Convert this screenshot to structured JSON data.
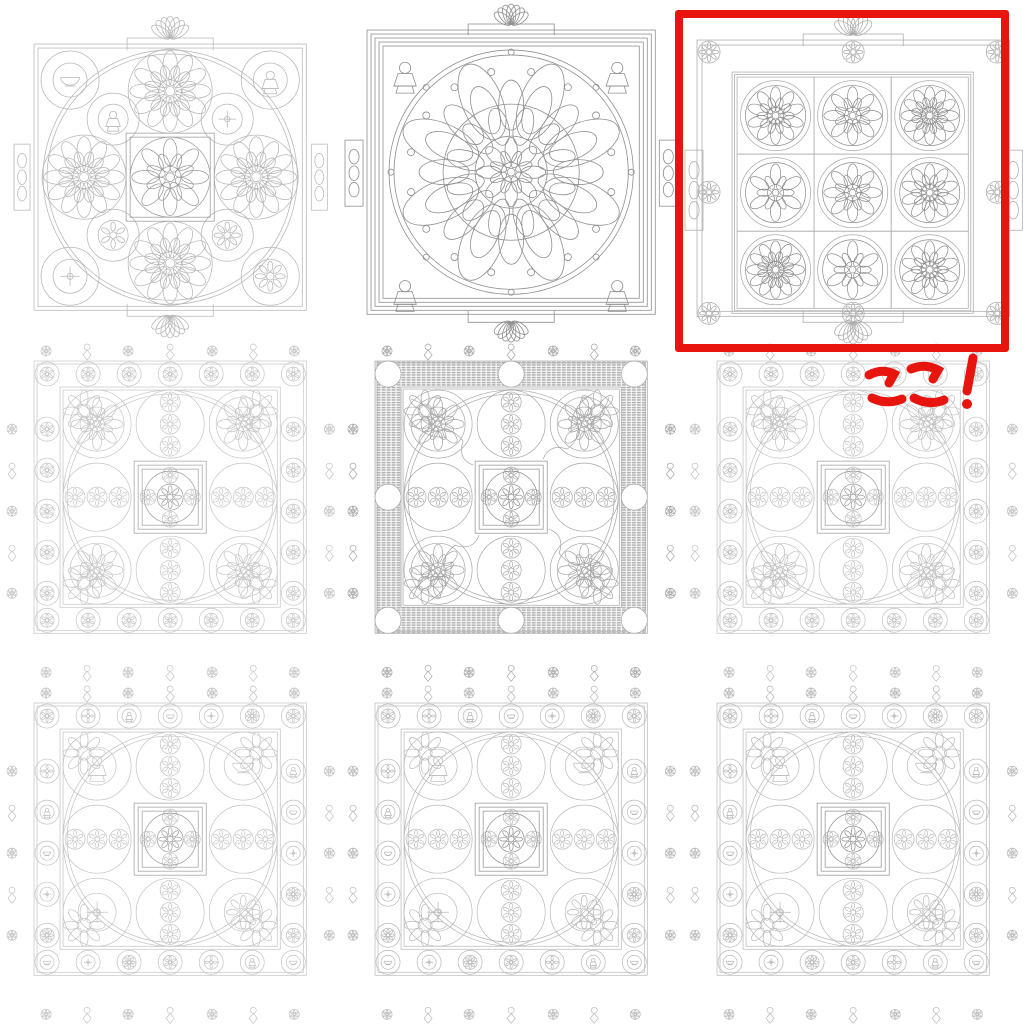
{
  "page": {
    "background": "#ffffff",
    "description": "three by three sheet of mandala line drawings"
  },
  "gallery": {
    "rows": 3,
    "cols": 3,
    "cells": [
      {
        "name": "mandala-ring-nine-medallions",
        "variant": "ringNine",
        "stroke": "#b6b6b6",
        "accent": "#9a9a9a",
        "highlighted": false
      },
      {
        "name": "mandala-round-ornate",
        "variant": "roundOrnate",
        "stroke": "#8f8f8f",
        "accent": "#8f8f8f",
        "highlighted": false
      },
      {
        "name": "mandala-grid-nine-flowers",
        "variant": "gridNine",
        "stroke": "#ababab",
        "accent": "#8b8b8b",
        "highlighted": true
      },
      {
        "name": "mandala-circle-border-left",
        "variant": "circleBorder",
        "stroke": "#c5c5c5",
        "accent": "#9e9e9e",
        "highlighted": false
      },
      {
        "name": "mandala-checker-border",
        "variant": "checkerBorder",
        "stroke": "#a6a6a6",
        "accent": "#8d8d8d",
        "band": "#b0b0b0",
        "highlighted": false
      },
      {
        "name": "mandala-circle-border-right",
        "variant": "circleBorder",
        "stroke": "#c0c0c0",
        "accent": "#999999",
        "highlighted": false
      },
      {
        "name": "mandala-symbol-border-left",
        "variant": "symbolBorder",
        "stroke": "#c2c2c2",
        "accent": "#9b9b9b",
        "highlighted": false
      },
      {
        "name": "mandala-symbol-border-middle",
        "variant": "symbolBorder",
        "stroke": "#b8b8b8",
        "accent": "#8e8e8e",
        "highlighted": false
      },
      {
        "name": "mandala-symbol-border-right",
        "variant": "symbolBorder",
        "stroke": "#b8b8b8",
        "accent": "#8e8e8e",
        "highlighted": false
      }
    ]
  },
  "annotation": {
    "text": "ここ!",
    "color": "#e8150f",
    "box": {
      "left": 675,
      "top": 10,
      "width": 334,
      "height": 342,
      "stroke_width": 8
    }
  }
}
